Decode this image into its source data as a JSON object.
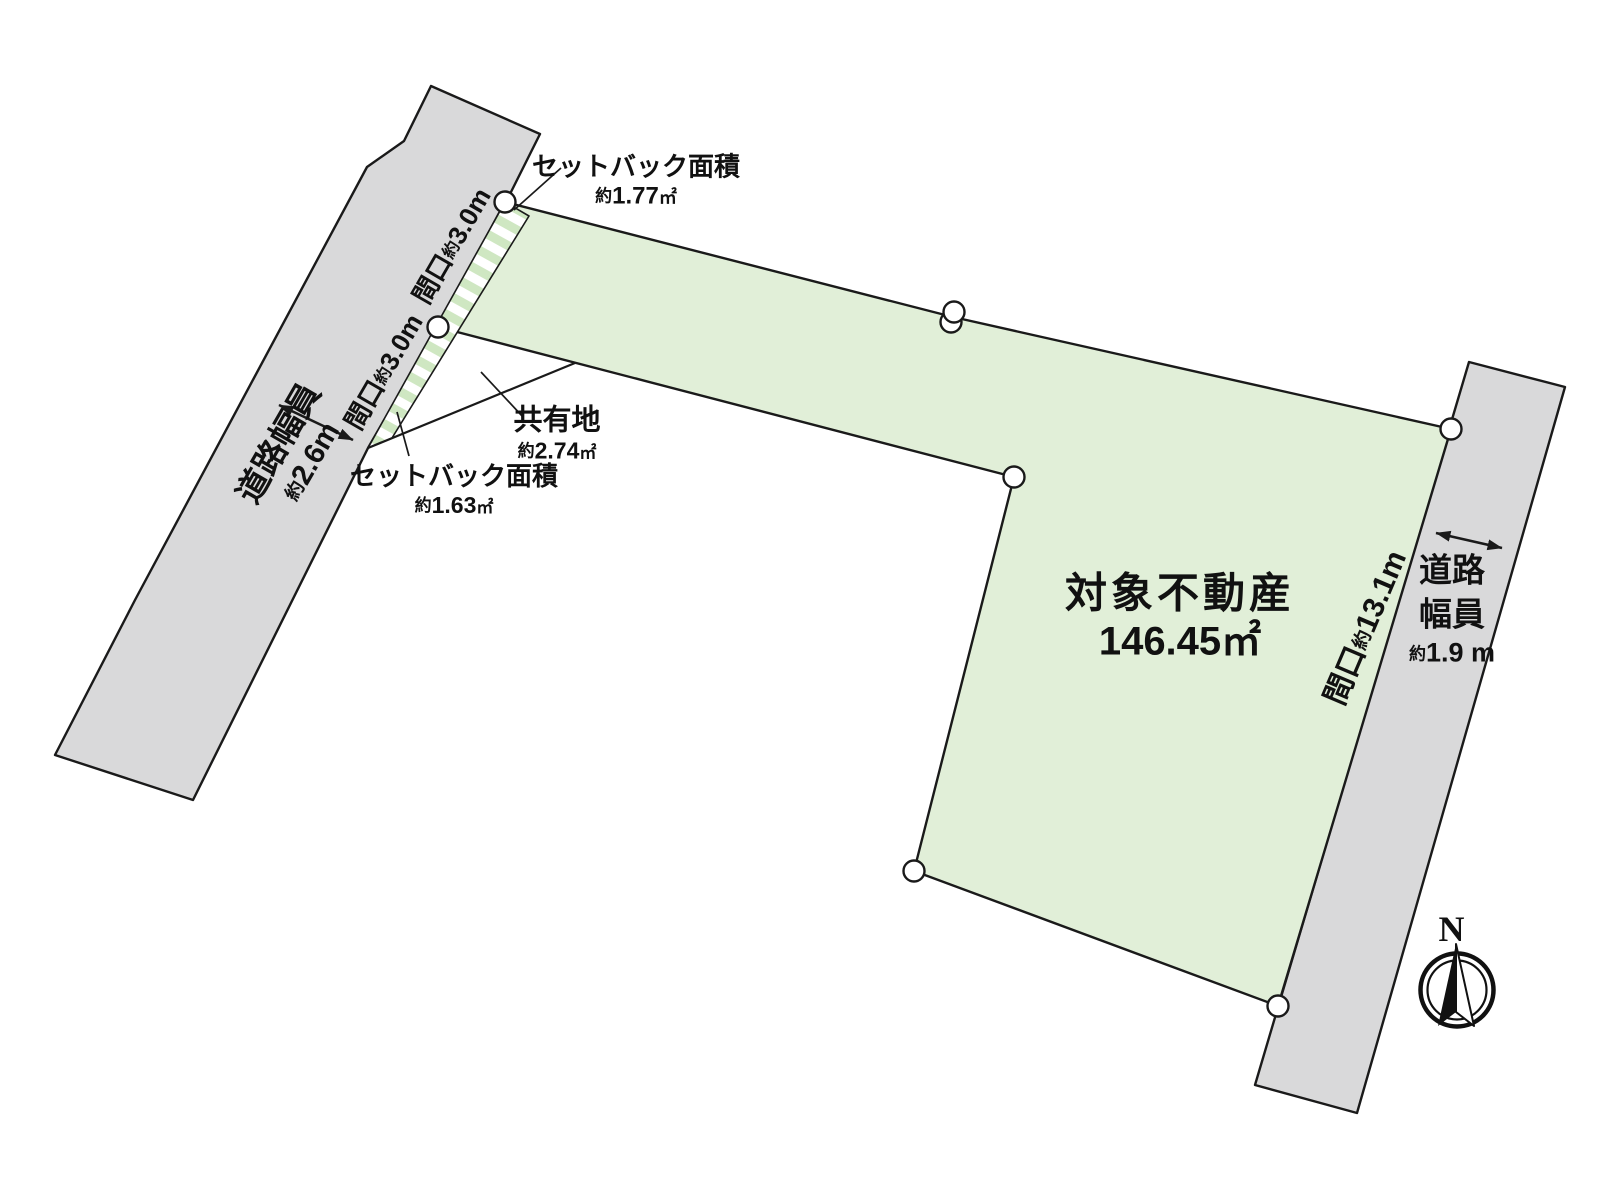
{
  "colors": {
    "road_fill": "#d9d9da",
    "plot_fill": "#e1efd8",
    "hatch_stripe": "#cfe7c2",
    "line": "#1a1a1a"
  },
  "plot": {
    "name": "対象不動産",
    "area": "146.45㎡"
  },
  "setback_top": {
    "label": "セットバック面積",
    "approx": "約",
    "area": "1.77",
    "unit": "㎡"
  },
  "setback_left": {
    "label": "セットバック面積",
    "approx": "約",
    "area": "1.63",
    "unit": "㎡"
  },
  "shared_land": {
    "label": "共有地",
    "approx": "約",
    "area": "2.74",
    "unit": "㎡"
  },
  "frontage_left_upper": {
    "label": "間口",
    "approx": "約",
    "value": "3.0m"
  },
  "frontage_left_lower": {
    "label": "間口",
    "approx": "約",
    "value": "3.0m"
  },
  "frontage_right": {
    "label": "間口",
    "approx": "約",
    "value": "13.1m"
  },
  "road_width_left": {
    "label": "道路幅員",
    "approx": "約",
    "value": "2.6m"
  },
  "road_width_right": {
    "label_line1": "道路",
    "label_line2": "幅員",
    "approx": "約",
    "value": "1.9 m"
  },
  "compass": {
    "north": "N"
  }
}
